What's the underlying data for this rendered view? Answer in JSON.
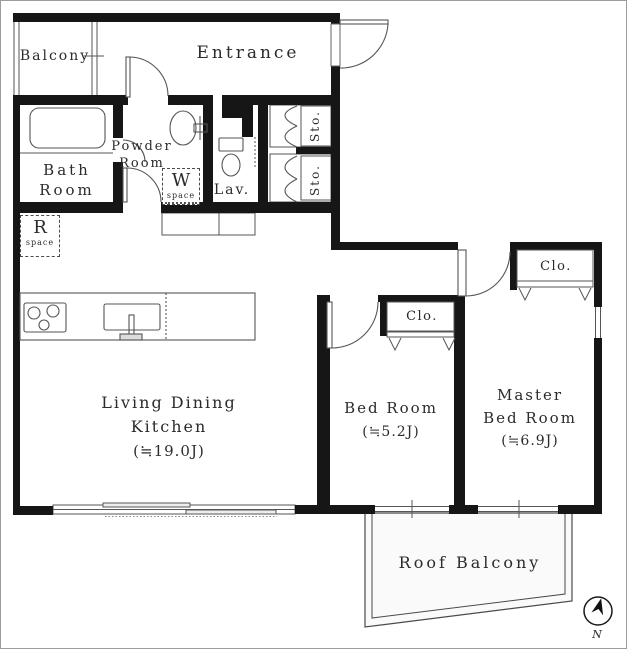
{
  "plan": {
    "rooms": {
      "balcony": {
        "label": "Balcony"
      },
      "entrance": {
        "label": "Entrance"
      },
      "bath": {
        "line1": "Bath",
        "line2": "Room"
      },
      "powder": {
        "line1": "Powder",
        "line2": "Room"
      },
      "lav": {
        "label": "Lav."
      },
      "sto1": {
        "label": "Sto."
      },
      "sto2": {
        "label": "Sto."
      },
      "ldk": {
        "line1": "Living Dining",
        "line2": "Kitchen",
        "area": "(≒19.0J)"
      },
      "bedroom": {
        "line1": "Bed Room",
        "area": "(≒5.2J)"
      },
      "master": {
        "line1": "Master",
        "line2": "Bed Room",
        "area": "(≒6.9J)"
      },
      "roof_balcony": {
        "label": "Roof Balcony"
      },
      "closet_bedroom": {
        "label": "Clo."
      },
      "closet_master": {
        "label": "Clo."
      }
    },
    "symbols": {
      "w_space": {
        "letter": "W",
        "caption": "space"
      },
      "r_space": {
        "letter": "R",
        "caption": "space"
      },
      "compass": {
        "label": "N"
      }
    },
    "colors": {
      "wall": "#161616",
      "line": "#555555",
      "text": "#2b2b2b",
      "balcony_fill": "#fafafa"
    }
  }
}
